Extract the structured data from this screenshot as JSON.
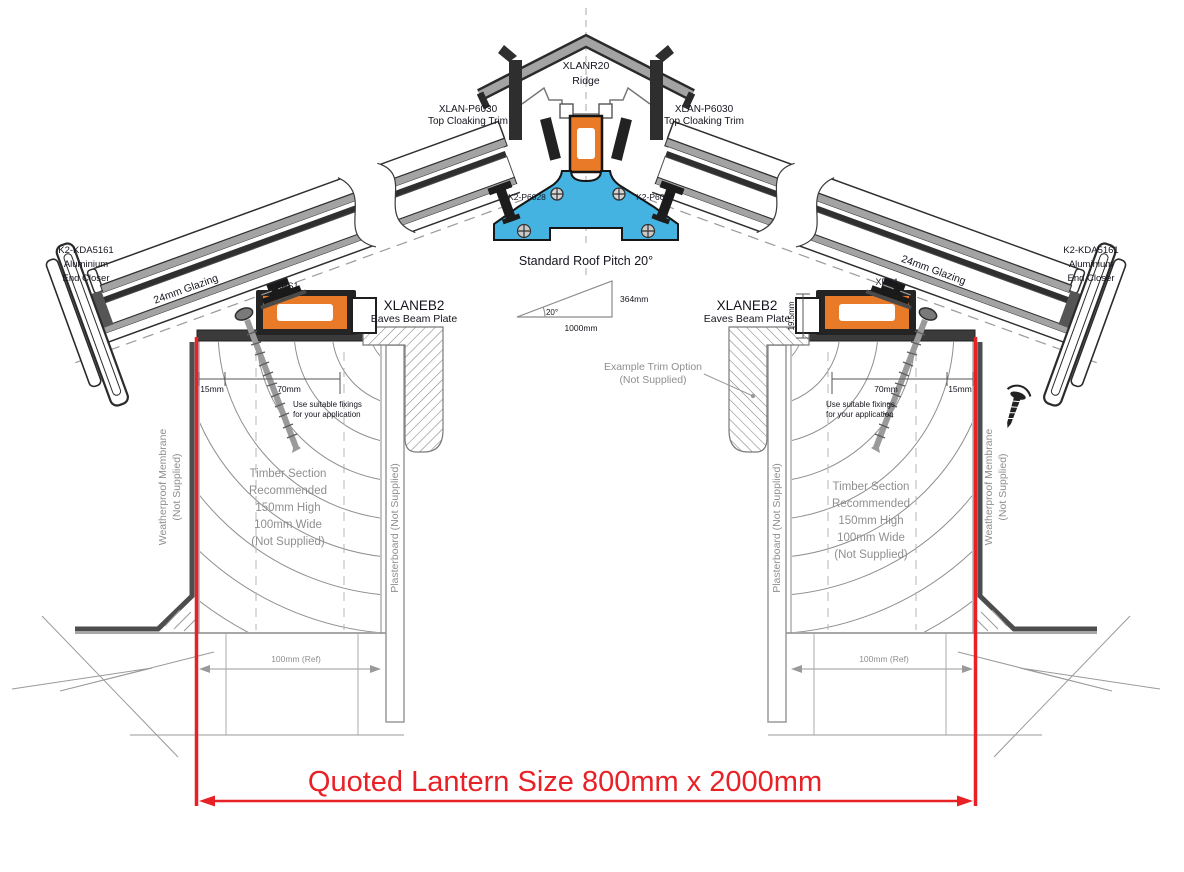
{
  "title": "Roof lantern ridge and eaves section detail",
  "colors": {
    "accent_red": "#e82127",
    "profile_orange": "#e87a28",
    "profile_blue": "#45b3e2",
    "trim_grey": "#a3a3a3",
    "outline_dark": "#2f2f2f",
    "label_dark": "#14141e",
    "label_grey": "#8f8f8f"
  },
  "ridge": {
    "code": "XLANR20",
    "name": "Ridge"
  },
  "top_cloaking": {
    "code": "XLAN-P6030",
    "name": "Top Cloaking Trim"
  },
  "ridge_fixing": {
    "code": "K2-P6028"
  },
  "pitch": {
    "title": "Standard Roof Pitch 20°",
    "angle": "20°",
    "rise": "364mm",
    "run": "1000mm"
  },
  "eaves_beam": {
    "code": "XLANEB2",
    "name": "Eaves Beam Plate"
  },
  "end_closer": {
    "line1": "K2-KDA5161",
    "line2": "Aluminium",
    "line3": "End Closer"
  },
  "glazing": {
    "label": "24mm Glazing"
  },
  "glazing_support": {
    "label": "XPS1"
  },
  "dimensions": {
    "edge": "15mm",
    "fixing_zone": "70mm",
    "beam_height": "19.5mm",
    "ref_width": "100mm (Ref)"
  },
  "fixing_note": {
    "line1": "Use suitable fixings",
    "line2": "for your application"
  },
  "timber_note": {
    "line1": "Timber Section",
    "line2": "Recommended",
    "line3": "150mm High",
    "line4": "100mm Wide",
    "line5": "(Not Supplied)"
  },
  "membrane_note": {
    "line1": "Weatherproof Membrane",
    "line2": "(Not Supplied)"
  },
  "plasterboard_note": {
    "label": "Plasterboard (Not Supplied)"
  },
  "trim_option_note": {
    "line1": "Example  Trim Option",
    "line2": "(Not Supplied)"
  },
  "quoted_size": {
    "label": "Quoted Lantern Size 800mm x 2000mm"
  }
}
